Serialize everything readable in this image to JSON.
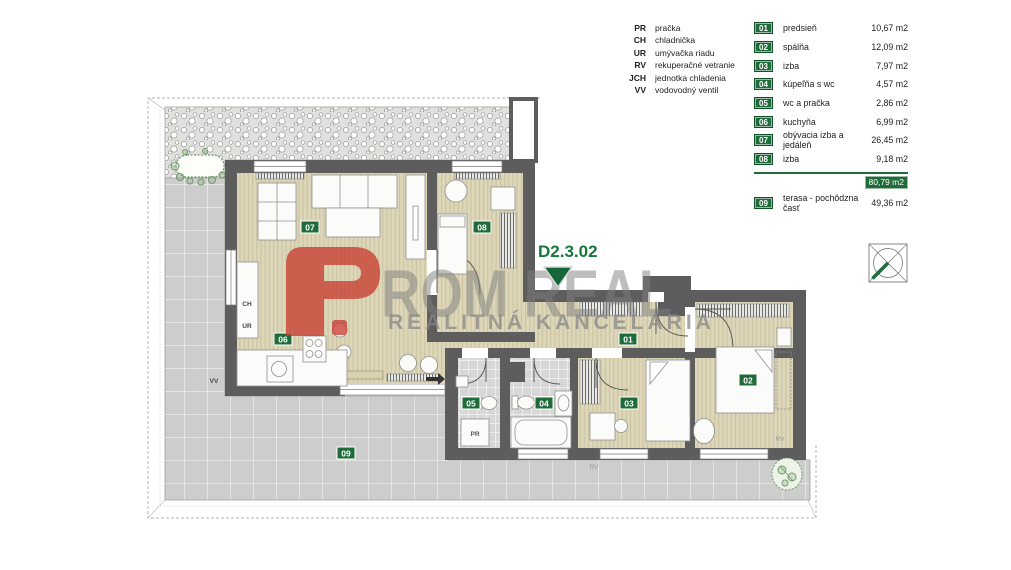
{
  "legend": {
    "items": [
      {
        "abbr": "PR",
        "label": "pračka"
      },
      {
        "abbr": "CH",
        "label": "chladnička"
      },
      {
        "abbr": "UR",
        "label": "umývačka riadu"
      },
      {
        "abbr": "RV",
        "label": "rekuperačné vetranie"
      },
      {
        "abbr": "JCH",
        "label": "jednotka chladenia"
      },
      {
        "abbr": "VV",
        "label": "vodovodný ventil"
      }
    ]
  },
  "room_list": {
    "rooms": [
      {
        "num": "01",
        "name": "predsieň",
        "area": "10,67 m2"
      },
      {
        "num": "02",
        "name": "spálňa",
        "area": "12,09 m2"
      },
      {
        "num": "03",
        "name": "izba",
        "area": "7,97 m2"
      },
      {
        "num": "04",
        "name": "kúpeľňa s wc",
        "area": "4,57 m2"
      },
      {
        "num": "05",
        "name": "wc a pračka",
        "area": "2,86 m2"
      },
      {
        "num": "06",
        "name": "kuchyňa",
        "area": "6,99 m2"
      },
      {
        "num": "07",
        "name": "obývacia izba a jedáleň",
        "area": "26,45 m2"
      },
      {
        "num": "08",
        "name": "izba",
        "area": "9,18 m2"
      }
    ],
    "total_area": "80,79 m2",
    "terrace": {
      "num": "09",
      "name": "terasa - pochôdzna časť",
      "area": "49,36 m2"
    }
  },
  "plan": {
    "unit_label": "D2.3.02",
    "labels": {
      "ch": "CH",
      "ur": "UR",
      "vv": "VV",
      "pr": "PR",
      "rv": "RV"
    }
  },
  "watermark": {
    "logo_letter": "P",
    "title_rest": "ROM REAL",
    "subtitle": "REALITNÁ KANCELÁRIA"
  },
  "icons": {
    "north_arrow": "compass-square-icon",
    "planter": "greenery-icon",
    "bush": "greenery-icon"
  },
  "colors": {
    "badge_green": "#1f6b3a",
    "accent_red": "#c84a3f",
    "floor_beige": "#ddd6b8",
    "wall_gray": "#5d5d5d",
    "terrace_gray": "#cdcdcd",
    "watermark_gray": "#8c8c8c"
  }
}
